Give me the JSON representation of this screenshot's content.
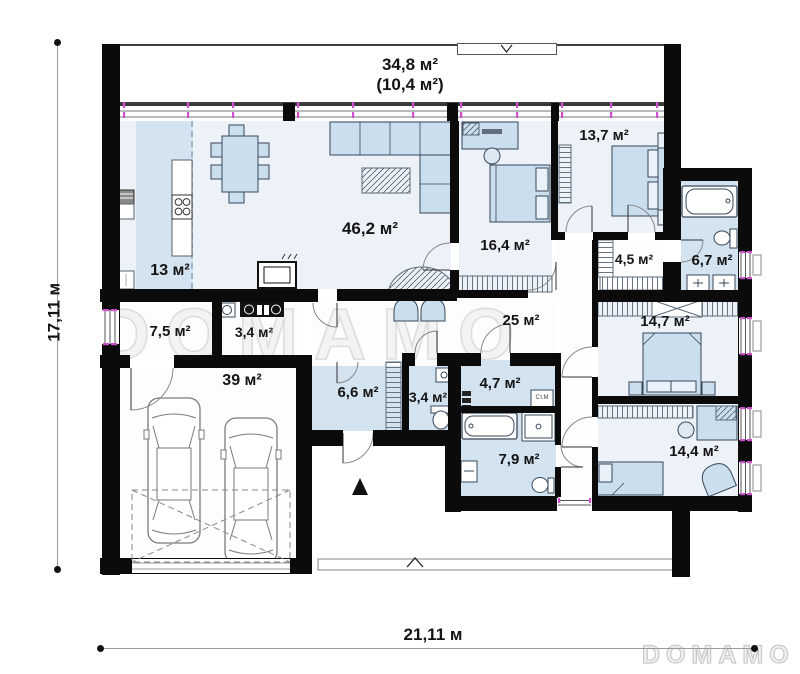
{
  "watermarks": {
    "center": "DOMAMO",
    "corner": "DOMAMO"
  },
  "dimensions": {
    "height": "17,11 м",
    "width": "21,11 м"
  },
  "terrace": {
    "line1": "34,8 м²",
    "line2": "(10,4 м²)"
  },
  "rooms": {
    "kitchen": "13 м²",
    "living": "46,2 м²",
    "bedroom1": "16,4 м²",
    "bedroom2": "13,7 м²",
    "closet": "4,5 м²",
    "bath1": "6,7 м²",
    "utility": "7,5 м²",
    "boiler": "3,4 м²",
    "corridor": "25 м²",
    "bedroom3": "14,7 м²",
    "garage": "39 м²",
    "hall": "6,6 м²",
    "wc": "3,4 м²",
    "laundry": "4,7 м²",
    "bath2": "7,9 м²",
    "bedroom4": "14,4 м²"
  },
  "appliances": {
    "washer": "Ст.М"
  },
  "colors": {
    "wall": "#0b0b0b",
    "floor_blue": "#d4e3f0",
    "floor_light": "#edf2f8",
    "furniture": "#cbdeee",
    "window_tick": "#cf4fcf",
    "watermark": "#dddddd"
  }
}
